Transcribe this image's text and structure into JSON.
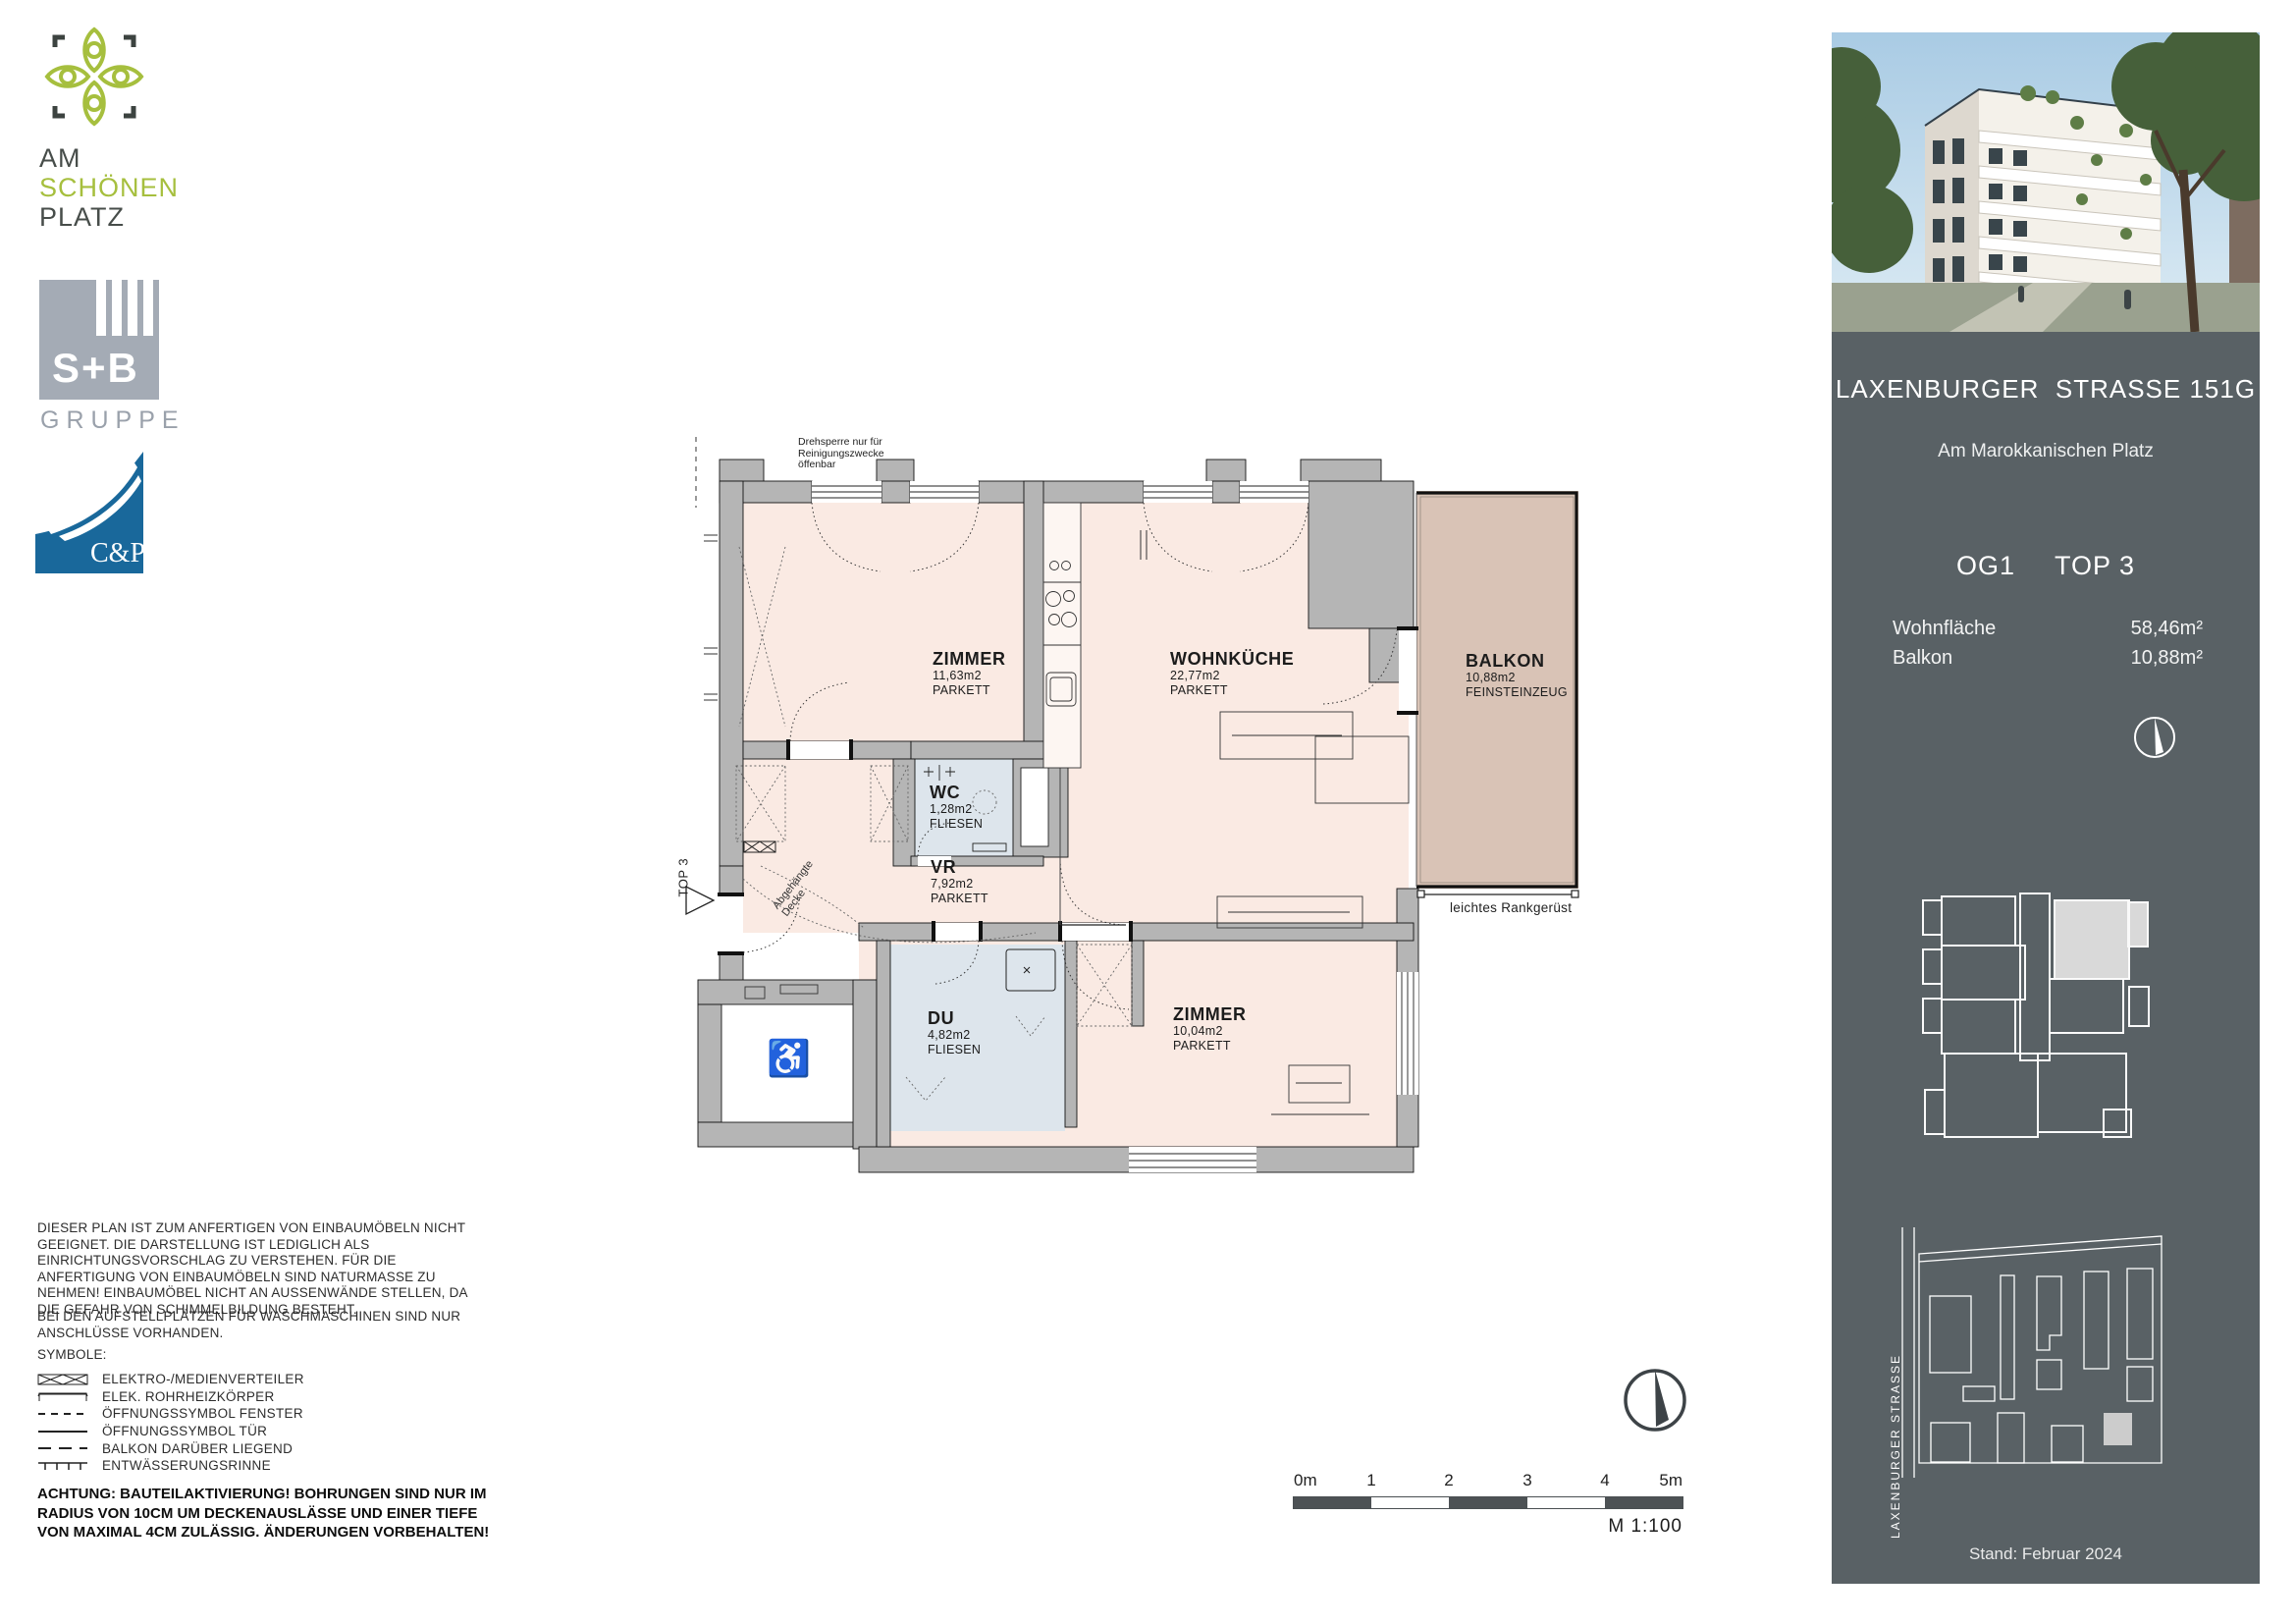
{
  "branding": {
    "project": {
      "line1": "AM",
      "line2": "SCHÖNEN",
      "line3": "PLATZ"
    },
    "sb": {
      "name": "S+B",
      "sub": "GRUPPE"
    },
    "cp": {
      "name": "C&P"
    }
  },
  "plan": {
    "rooms": [
      {
        "name": "ZIMMER",
        "area": "11,63m2",
        "floor": "PARKETT"
      },
      {
        "name": "WOHNKÜCHE",
        "area": "22,77m2",
        "floor": "PARKETT"
      },
      {
        "name": "BALKON",
        "area": "10,88m2",
        "floor": "FEINSTEINZEUG"
      },
      {
        "name": "WC",
        "area": "1,28m2",
        "floor": "FLIESEN"
      },
      {
        "name": "VR",
        "area": "7,92m2",
        "floor": "PARKETT"
      },
      {
        "name": "DU",
        "area": "4,82m2",
        "floor": "FLIESEN"
      },
      {
        "name": "ZIMMER",
        "area": "10,04m2",
        "floor": "PARKETT"
      }
    ],
    "annotations": {
      "drehsperre": "Drehsperre nur für\nReinigungszwecke\nöffenbar",
      "abgehaengte_decke": "Abgehängte\nDecke",
      "rankgeruest": "leichtes Rankgerüst",
      "top_marker": "TOP 3"
    }
  },
  "notes": {
    "disclaimer": "DIESER PLAN IST ZUM ANFERTIGEN VON EINBAUMÖBELN NICHT GEEIGNET. DIE DARSTELLUNG IST LEDIGLICH ALS EINRICHTUNGSVORSCHLAG ZU VERSTEHEN. FÜR DIE ANFERTIGUNG VON EINBAUMÖBELN SIND NATURMASSE ZU NEHMEN! EINBAUMÖBEL NICHT AN AUSSENWÄNDE STELLEN, DA DIE GEFAHR VON SCHIMMELBILDUNG BESTEHT.",
    "washer": "BEI DEN AUFSTELLPLÄTZEN FÜR WASCHMASCHINEN SIND NUR ANSCHLÜSSE VORHANDEN.",
    "symbols_title": "SYMBOLE:",
    "achtung": "ACHTUNG: BAUTEILAKTIVIERUNG! BOHRUNGEN SIND NUR IM RADIUS VON 10CM UM DECKENAUSLÄSSE  UND EINER TIEFE VON MAXIMAL 4CM ZULÄSSIG. ÄNDERUNGEN VORBEHALTEN!"
  },
  "legend": {
    "items": [
      {
        "label": "ELEKTRO-/MEDIENVERTEILER"
      },
      {
        "label": "ELEK. ROHRHEIZKÖRPER"
      },
      {
        "label": "ÖFFNUNGSSYMBOL FENSTER"
      },
      {
        "label": "ÖFFNUNGSSYMBOL TÜR"
      },
      {
        "label": "BALKON DARÜBER LIEGEND"
      },
      {
        "label": "ENTWÄSSERUNGSRINNE"
      }
    ]
  },
  "scalebar": {
    "ticks": [
      "0m",
      "1",
      "2",
      "3",
      "4",
      "5m"
    ],
    "scale_label": "M 1:100"
  },
  "sidebar": {
    "address": "LAXENBURGER  STRASSE 151G",
    "subtitle": "Am Marokkanischen Platz",
    "floor": "OG1",
    "unit": "TOP 3",
    "rows": [
      {
        "label": "Wohnfläche",
        "value": "58,46m²"
      },
      {
        "label": "Balkon",
        "value": "10,88m²"
      }
    ],
    "siteplan_street": "LAXENBURGER STRASSE",
    "date": "Stand: Februar 2024"
  }
}
